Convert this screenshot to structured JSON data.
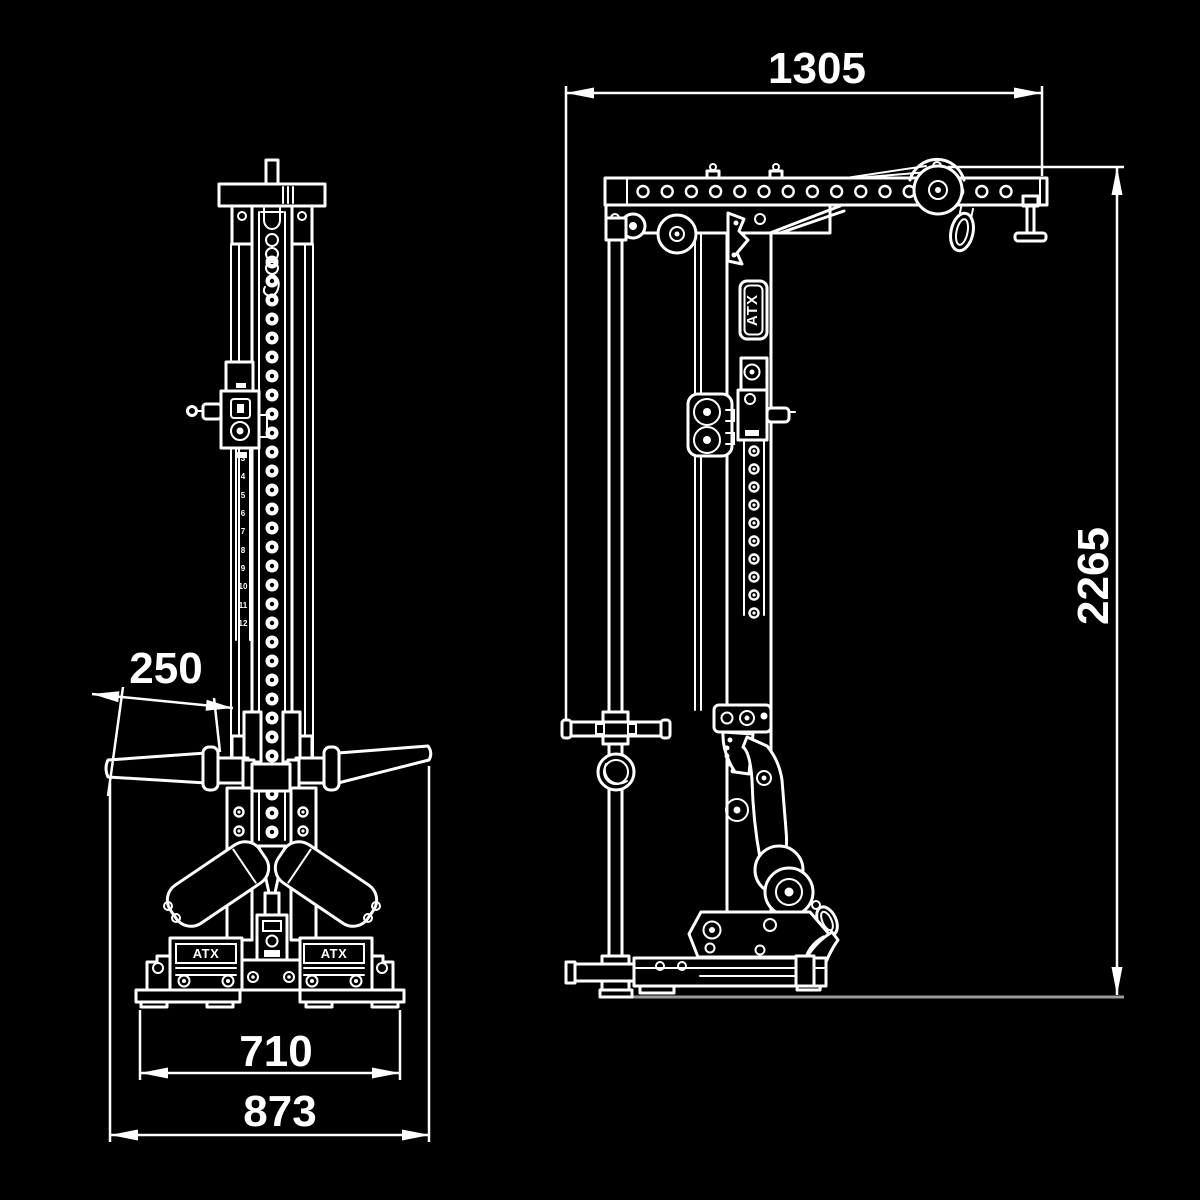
{
  "brand": {
    "label": "ATX"
  },
  "colors": {
    "background": "#000000",
    "line": "#ffffff",
    "floor_line": "#9a9a9a",
    "text": "#ffffff"
  },
  "dimensions": {
    "top_arm_length": "1305",
    "overall_height": "2265",
    "handle_grip_length": "250",
    "inner_base_width": "710",
    "overall_base_width": "873"
  },
  "front": {
    "scale_numbers": [
      "3",
      "4",
      "5",
      "6",
      "7",
      "8",
      "9",
      "10",
      "11",
      "12"
    ]
  }
}
